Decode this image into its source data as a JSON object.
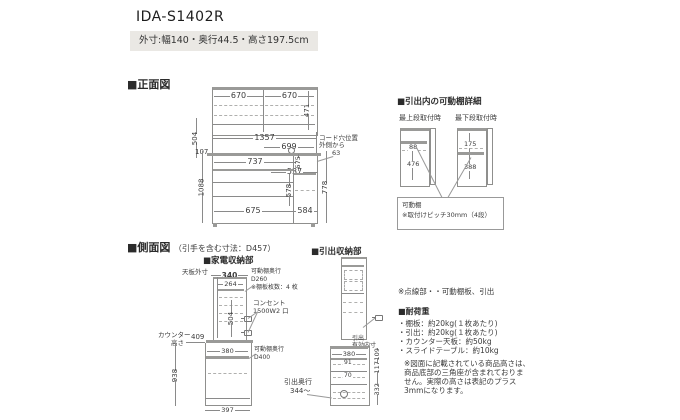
{
  "header": {
    "title": "IDA-S1402R",
    "subtitle": "外寸:幅140・奥行44.5・高さ197.5cm"
  },
  "front": {
    "heading": "■正面図",
    "dims": {
      "top_left": "670",
      "top_right": "670",
      "upper_height": "471",
      "inner_width": "1357",
      "cord_width": "699",
      "upper_space_height": "504",
      "left_offset": "107",
      "counter_width": "737",
      "counter_gap": "575",
      "right_width": "537",
      "lower_height": "1088",
      "mid_height": "578",
      "bottom_left": "675",
      "bottom_right": "584",
      "right_height": "778",
      "cord_offset": "63"
    },
    "cord_note_1": "コード穴位置",
    "cord_note_2": "外側から"
  },
  "shelf_detail": {
    "heading": "■引出内の可動棚詳細",
    "top_label": "最上段取付時",
    "bottom_label": "最下段取付時",
    "top_upper": "88",
    "top_lower": "476",
    "bottom_upper": "175",
    "bottom_lower": "388",
    "note_1": "可動棚",
    "note_2": "※取付けピッチ30mm（4段）"
  },
  "side": {
    "heading": "■側面図",
    "heading_sub": "（引手を含む寸法：D457）",
    "appliance": {
      "heading": "■家電収納部",
      "top_label": "天板外寸",
      "top_width": "340",
      "inner_width": "264",
      "shelf_note_1": "可動棚奥行",
      "shelf_note_2": "D260",
      "shelf_note_3": "※棚板枚数：4 枚",
      "outlet_note_1": "コンセント",
      "outlet_note_2": "1500W2 口",
      "space_height": "504",
      "counter_height_dim": "409",
      "counter_label_1": "カウンター",
      "counter_label_2": "高さ",
      "shelf_width": "380",
      "lower_shelf_note_1": "可動棚奥行",
      "lower_shelf_note_2": "D400",
      "lower_height": "938",
      "base_width": "397"
    },
    "drawer": {
      "heading": "■引出収納部",
      "inner_label_1": "引出",
      "inner_label_2": "有効内寸",
      "top_width": "380",
      "inner_h1": "91",
      "inner_h2": "70",
      "depth_note_1": "引出奥行",
      "depth_note_2": "344～",
      "h1": "109",
      "h2": "117",
      "h3": "332"
    }
  },
  "notes": {
    "dotted": "※点線部・・可動棚板、引出",
    "load_heading": "■耐荷重",
    "load_items": [
      "・棚板：約20kg(１枚あたり)",
      "・引出：約20kg(１枚あたり)",
      "・カウンター天板：約50kg",
      "・スライドテーブル：約10kg"
    ],
    "remark_1": "※図面に記載されている商品高さは、",
    "remark_2": "商品底部の三角座が含まれておりま",
    "remark_3": "せん。実際の高さは表記のプラス",
    "remark_4": "3mmになります。"
  },
  "colors": {
    "line": "#8a8a8a",
    "text": "#3c3c3c",
    "subtitle_bg": "#eae8e4"
  }
}
